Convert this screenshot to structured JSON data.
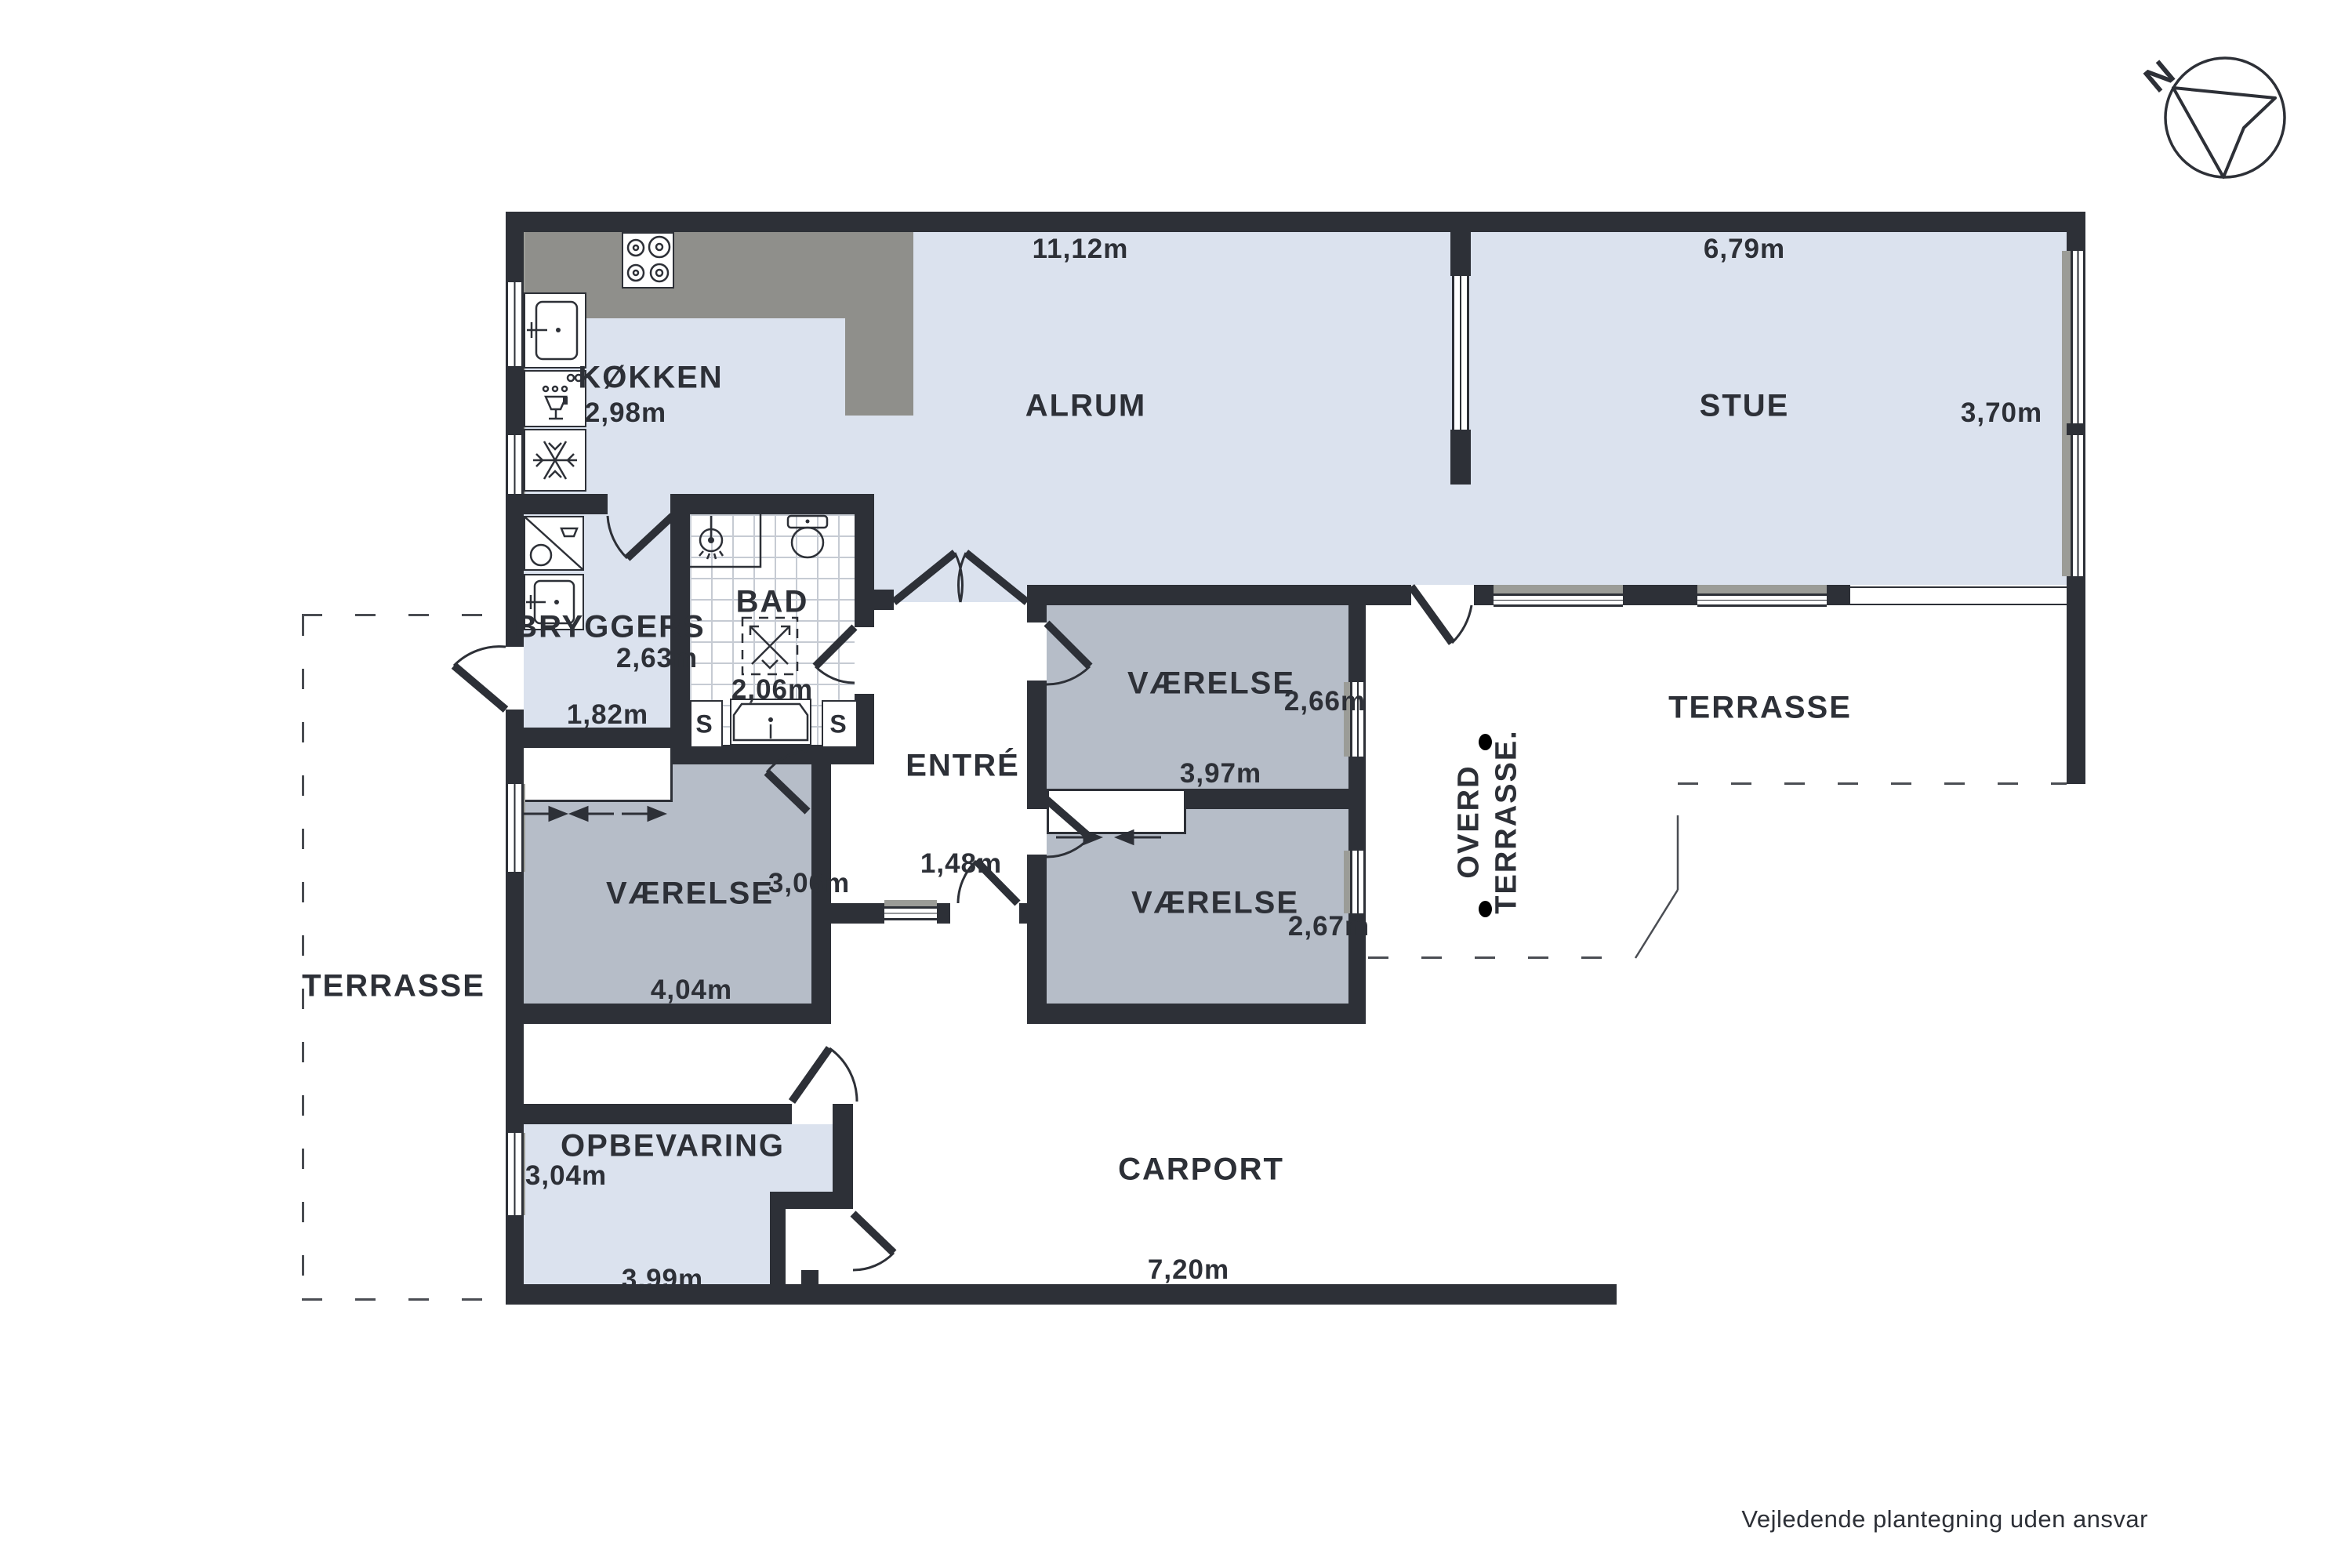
{
  "colors": {
    "wall": "#2d3037",
    "ink": "#2d3037",
    "floor": "#dbe2ee",
    "room": "#b6bdc8",
    "counter": "#8f8f8b",
    "sill": "#9b9c97",
    "tile": "#c6cbd3",
    "dash": "#4a4d53"
  },
  "rooms": {
    "kokken": {
      "name": "KØKKEN",
      "w": "2,98m"
    },
    "alrum": {
      "name": "ALRUM",
      "w": "11,12m"
    },
    "stue": {
      "name": "STUE",
      "w": "6,79m",
      "h": "3,70m"
    },
    "bryggers": {
      "name": "BRYGGERS",
      "w": "2,63m",
      "h": "1,82m"
    },
    "bad": {
      "name": "BAD",
      "w": "2,06m",
      "s_left": "S",
      "s_right": "S"
    },
    "vaerelse_ne": {
      "name": "VÆRELSE",
      "h": "2,66m",
      "w": "3,97m"
    },
    "vaerelse_sw": {
      "name": "VÆRELSE",
      "h": "3,06m",
      "w": "4,04m"
    },
    "vaerelse_se": {
      "name": "VÆRELSE",
      "h": "2,67m"
    },
    "entre": {
      "name": "ENTRÉ",
      "w": "1,48m"
    },
    "terrasse_left": {
      "name": "TERRASSE"
    },
    "terrasse_right": {
      "name": "TERRASSE"
    },
    "overdaekket": {
      "line1": "OVERD",
      "line2": "TERRASSE."
    },
    "opbevaring": {
      "name": "OPBEVARING",
      "h": "3,04m",
      "w": "3,99m"
    },
    "carport": {
      "name": "CARPORT",
      "w": "7,20m"
    }
  },
  "compass": {
    "north": "N"
  },
  "footer": {
    "disclaimer": "Vejledende plantegning uden ansvar"
  }
}
